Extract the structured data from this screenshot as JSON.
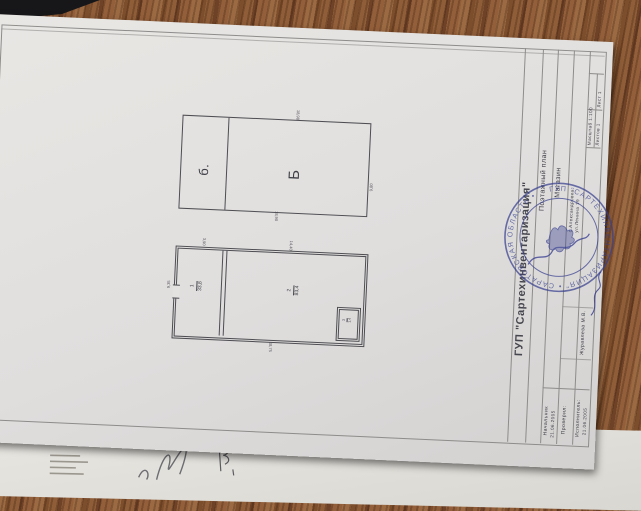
{
  "title_block": {
    "organization": "ГУП \"Сартехинвентаризация\"",
    "document_title": "Поэтажный план",
    "object_name": "Магазин",
    "address_line1": "с.Александровка",
    "address_line2": "ул.Ленина 19",
    "sheet_label": "Лист 1",
    "sheets_label": "Листов 1",
    "scale_label": "Масштаб 1:100",
    "signatures": {
      "chief_label": "Начальник",
      "chief_date": "21.06.2005",
      "checked_label": "Проверил:",
      "checked_name": "Журавлева М.В.",
      "executor_label": "Исполнитель:",
      "executor_date": "21.06.2005"
    }
  },
  "stamp": {
    "ring_text": "ГУП \"САРТЕХИНВЕНТАРИЗАЦИЯ\"  •  САРАТОВСКАЯ ОБЛАСТЬ  •",
    "color": "#38408f"
  },
  "plan_upper": {
    "label_small_room": "б.",
    "label_large_room": "Б",
    "dim_top": "18,98",
    "dim_right": "9,80",
    "dim_bottom": "18,90"
  },
  "plan_lower": {
    "room1_number": "1",
    "room1_area": "33,8",
    "room2_number": "2",
    "room2_area": "83,4",
    "room3_number": "3",
    "room3_area": "1,4",
    "dim_top_left": "3,90",
    "dim_top_right": "14,40",
    "dim_left": "9,35",
    "dim_bottom": "18,75"
  }
}
